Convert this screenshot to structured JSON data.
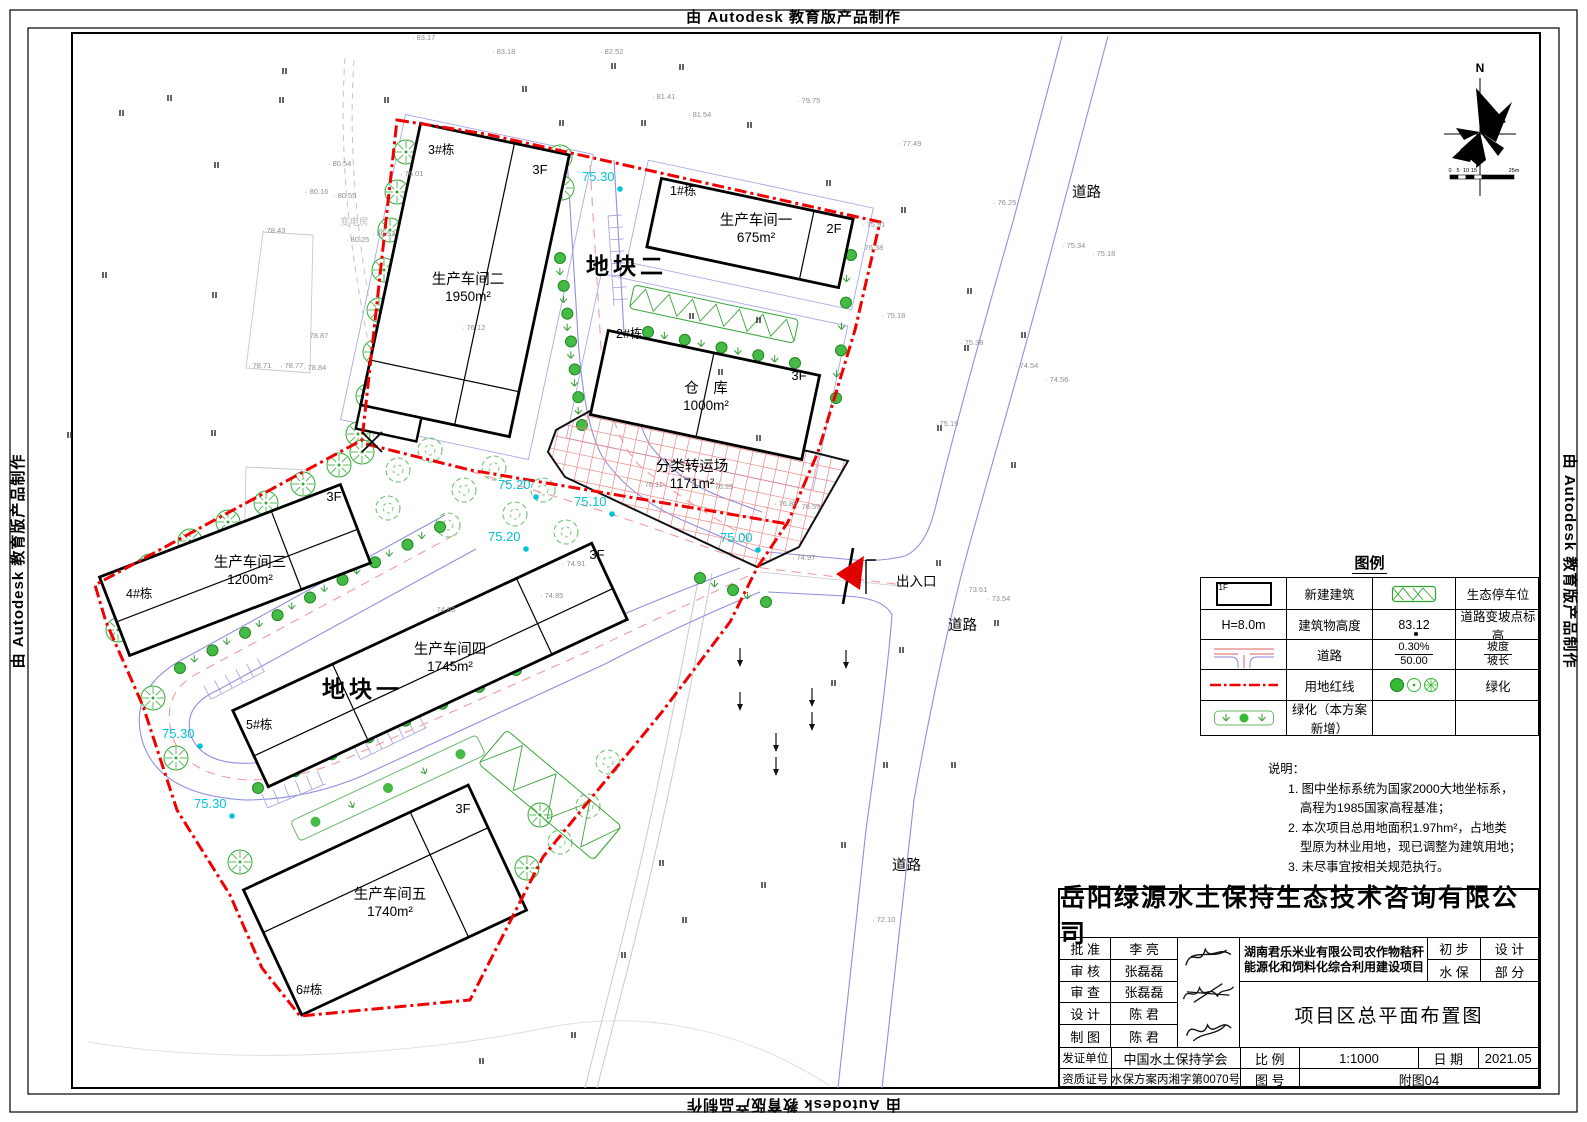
{
  "frame": {
    "autodesk_banner": "由 Autodesk 教育版产品制作"
  },
  "compass": {
    "north": "N",
    "scale_labels": [
      "0",
      "5",
      "10",
      "15",
      "25m"
    ]
  },
  "plan": {
    "block_labels": [
      {
        "t": "地块二",
        "x": 586,
        "y": 274
      },
      {
        "t": "地块一",
        "x": 322,
        "y": 697
      }
    ],
    "buildings": [
      {
        "tag": "3#栋",
        "tx": 428,
        "ty": 154,
        "name": "生产车间二",
        "area": "1950m²",
        "nx": 468,
        "ny": 284,
        "fl": "3F",
        "fx": 540,
        "fy": 174,
        "cx": 465,
        "cy": 280,
        "w": 152,
        "h": 288,
        "rot": 12
      },
      {
        "tag": "1#栋",
        "tx": 670,
        "ty": 195,
        "name": "生产车间一",
        "area": "675m²",
        "nx": 756,
        "ny": 225,
        "fl": "2F",
        "fx": 834,
        "fy": 233,
        "cx": 750,
        "cy": 233,
        "w": 196,
        "h": 70,
        "rot": 12
      },
      {
        "tag": "2#栋",
        "tx": 616,
        "ty": 338,
        "name": "仓　库",
        "area": "1000m²",
        "nx": 706,
        "ny": 393,
        "fl": "3F",
        "fx": 799,
        "fy": 380,
        "cx": 705,
        "cy": 395,
        "w": 216,
        "h": 86,
        "rot": 12
      },
      {
        "tag": "4#栋",
        "tx": 126,
        "ty": 598,
        "name": "生产车间三",
        "area": "1200m²",
        "nx": 250,
        "ny": 567,
        "fl": "3F",
        "fx": 334,
        "fy": 501,
        "cx": 235,
        "cy": 570,
        "w": 258,
        "h": 84,
        "rot": -21
      },
      {
        "tag": "5#栋",
        "tx": 246,
        "ty": 729,
        "name": "生产车间四",
        "area": "1745m²",
        "nx": 450,
        "ny": 654,
        "fl": "3F",
        "fx": 597,
        "fy": 559,
        "cx": 430,
        "cy": 665,
        "w": 396,
        "h": 84,
        "rot": -25
      },
      {
        "tag": "6#栋",
        "tx": 296,
        "ty": 994,
        "name": "生产车间五",
        "area": "1740m²",
        "nx": 390,
        "ny": 899,
        "fl": "3F",
        "fx": 463,
        "fy": 813,
        "cx": 385,
        "cy": 900,
        "w": 248,
        "h": 138,
        "rot": -25
      }
    ],
    "yard": {
      "name": "分类转运场",
      "area": "1171m²",
      "nx": 692,
      "ny": 471
    },
    "exit_label": "出入口",
    "road_labels": [
      {
        "t": "道路",
        "x": 1072,
        "y": 197
      },
      {
        "t": "道路",
        "x": 948,
        "y": 630
      },
      {
        "t": "道路",
        "x": 892,
        "y": 870
      }
    ],
    "substation": "变电房",
    "cyan": [
      [
        "75.30",
        582,
        181
      ],
      [
        "75.20",
        498,
        489
      ],
      [
        "75.10",
        574,
        506
      ],
      [
        "75.20",
        488,
        541
      ],
      [
        "75.00",
        720,
        542
      ],
      [
        "75.30",
        162,
        738
      ],
      [
        "75.30",
        194,
        808
      ]
    ],
    "spots": [
      [
        "83.17",
        412,
        40
      ],
      [
        "83.18",
        492,
        54
      ],
      [
        "82.52",
        600,
        54
      ],
      [
        "81.41",
        652,
        99
      ],
      [
        "81.54",
        688,
        117
      ],
      [
        "79.75",
        797,
        103
      ],
      [
        "77.49",
        898,
        146
      ],
      [
        "76.25",
        993,
        205
      ],
      [
        "75.34",
        1062,
        248
      ],
      [
        "75.18",
        1092,
        256
      ],
      [
        "80.54",
        328,
        166
      ],
      [
        "80.16",
        305,
        194
      ],
      [
        "80.55",
        333,
        198
      ],
      [
        "78.43",
        262,
        233
      ],
      [
        "80.52",
        372,
        236
      ],
      [
        "80.25",
        346,
        242
      ],
      [
        "76.01",
        400,
        176
      ],
      [
        "78.87",
        305,
        338
      ],
      [
        "78.71",
        248,
        368
      ],
      [
        "78.77",
        280,
        368
      ],
      [
        "78.84",
        303,
        370
      ],
      [
        "76.12",
        462,
        330
      ],
      [
        "75.91",
        862,
        227
      ],
      [
        "76.38",
        860,
        250
      ],
      [
        "75.18",
        882,
        318
      ],
      [
        "75.38",
        960,
        345
      ],
      [
        "74.54",
        1015,
        368
      ],
      [
        "74.56",
        1045,
        382
      ],
      [
        "75.19",
        935,
        426
      ],
      [
        "76.11",
        640,
        487
      ],
      [
        "76.25",
        710,
        489
      ],
      [
        "76.88",
        774,
        506
      ],
      [
        "76.59",
        797,
        509
      ],
      [
        "74.91",
        562,
        566
      ],
      [
        "74.97",
        792,
        560
      ],
      [
        "74.85",
        540,
        598
      ],
      [
        "74.83",
        432,
        612
      ],
      [
        "73.61",
        964,
        592
      ],
      [
        "73.54",
        987,
        601
      ],
      [
        "72.10",
        872,
        922
      ]
    ]
  },
  "legend": {
    "title": "图例",
    "bldg_icon_label": "1F",
    "r1c2": "新建建筑",
    "r1c4": "生态停车位",
    "r2c1": "H=8.0m",
    "r2c2": "建筑物高度",
    "r2c3": "83.12",
    "r2c4": "道路变坡点标高",
    "r3c2": "道路",
    "r3c3a": "0.30%",
    "r3c3b": "50.00",
    "r3c4a": "坡度",
    "r3c4b": "坡长",
    "r4c2": "用地红线",
    "r4c4": "绿化",
    "r5c2": "绿化（本方案新增）"
  },
  "notes": {
    "title": "说明：",
    "lines": [
      "1. 图中坐标系统为国家2000大地坐标系，",
      "高程为1985国家高程基准；",
      "2. 本次项目总用地面积1.97hm²，占地类",
      "型原为林业用地，现已调整为建筑用地；",
      "3. 未尽事宜按相关规范执行。"
    ]
  },
  "titleblock": {
    "company": "岳阳绿源水土保持生态技术咨询有限公司",
    "rows": [
      {
        "label": "批 准",
        "name": "李 亮"
      },
      {
        "label": "审 核",
        "name": "张磊磊"
      },
      {
        "label": "审 查",
        "name": "张磊磊"
      },
      {
        "label": "设 计",
        "name": "陈 君"
      },
      {
        "label": "制 图",
        "name": "陈 君"
      }
    ],
    "project_line1": "湖南君乐米业有限公司农作物秸秆",
    "project_line2": "能源化和饲料化综合利用建设项目",
    "stage_label": "初 步",
    "stage_value": "设 计",
    "part_label": "水 保",
    "part_value": "部 分",
    "drawing_title": "项目区总平面布置图",
    "issuer_label": "发证单位",
    "issuer": "中国水土保持学会",
    "scale_label": "比 例",
    "scale": "1:1000",
    "date_label": "日 期",
    "date": "2021.05",
    "cert_label": "资质证号",
    "cert": "水保方案丙湘字第0070号",
    "fig_label": "图 号",
    "fig": "附图04"
  }
}
